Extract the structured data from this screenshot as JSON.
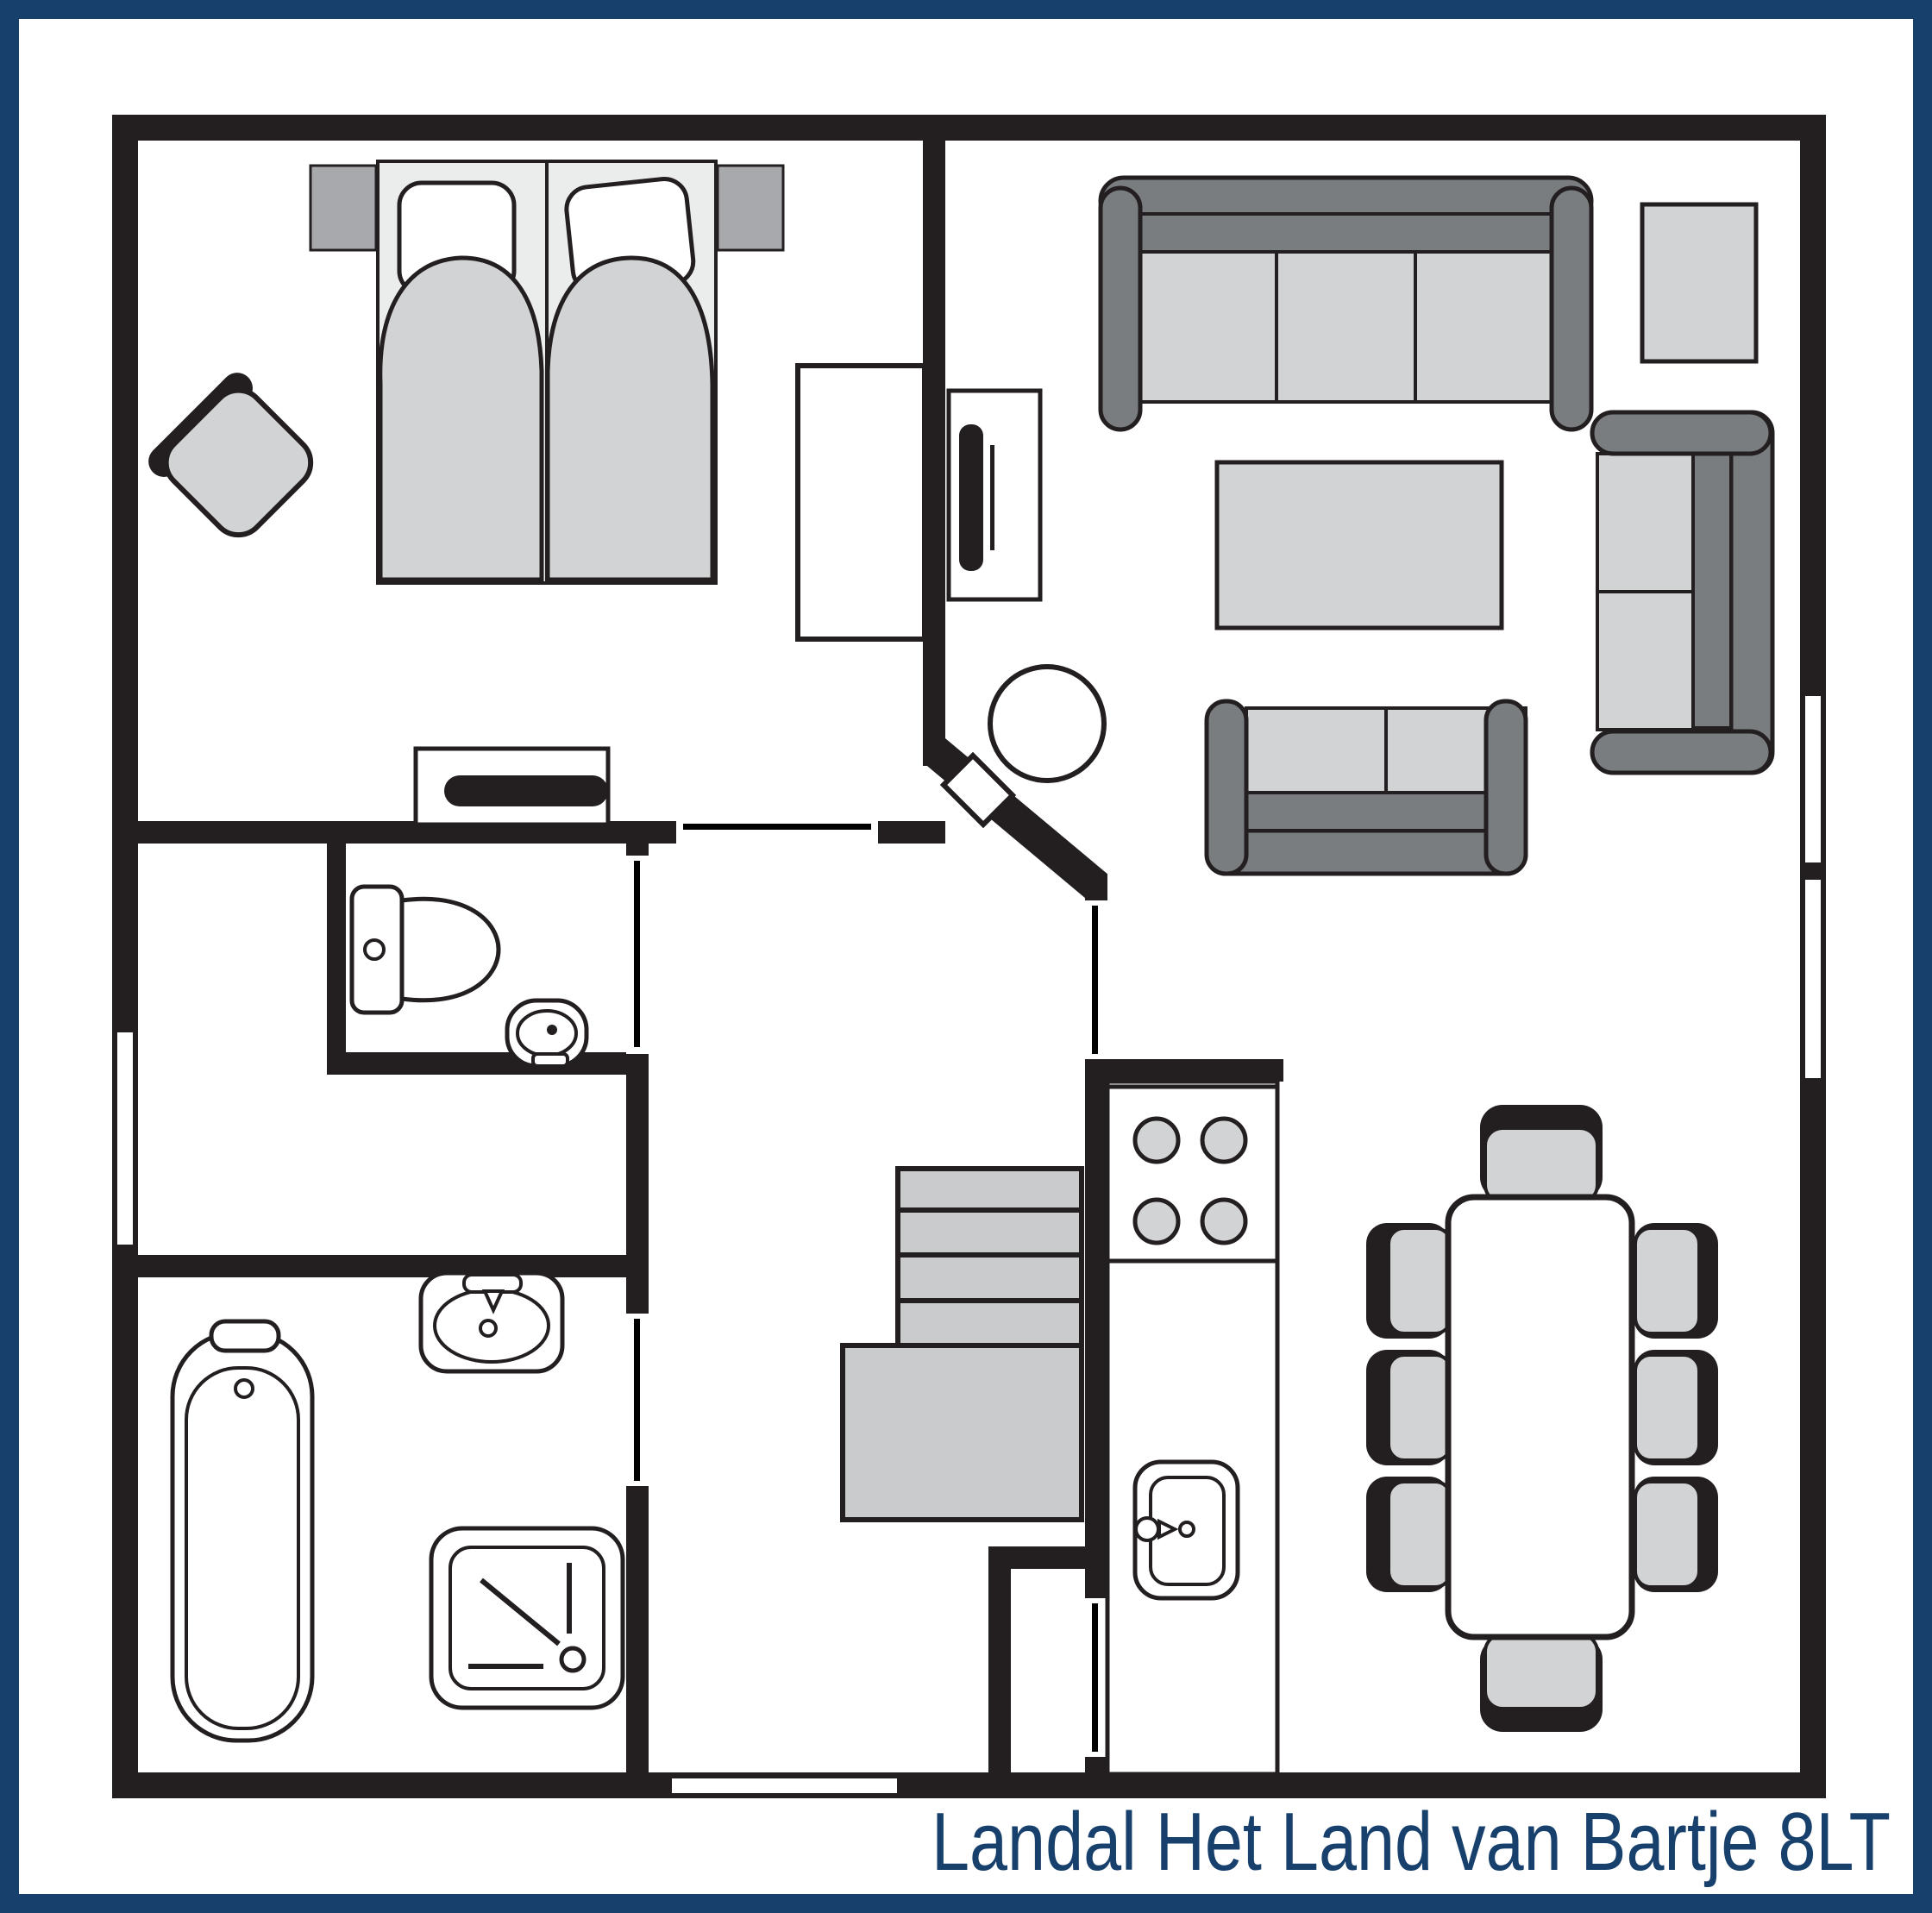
{
  "title": "Landal Het Land van Bartje 8LT",
  "colors": {
    "frame_navy": "#17406d",
    "wall": "#231f20",
    "furn_light": "#d2d3d5",
    "furn_mid": "#a7a9ac",
    "furn_dark": "#7a7d80",
    "stairs": "#c9cbcd",
    "bed": "#ebecec"
  },
  "floorplan": {
    "type": "holiday-cottage-ground-plan",
    "rooms": [
      "bedroom",
      "living-room",
      "hall",
      "toilet-room",
      "bathroom",
      "kitchen",
      "dining-area",
      "staircase",
      "entrance",
      "storage-closet"
    ],
    "furniture": [
      "double-bed",
      "pillow-left",
      "pillow-right",
      "nightstand-left",
      "nightstand-right",
      "bedroom-chair",
      "wardrobe",
      "dresser",
      "sofa-3-seat",
      "sofa-2-seat",
      "sofa-2-seat-vertical",
      "coffee-table",
      "side-table",
      "tv-cabinet",
      "wood-stove",
      "stairs",
      "kitchen-counter",
      "hob-4-burners",
      "kitchen-sink",
      "dining-table",
      "dining-chairs-x8",
      "toilet",
      "corner-washbasin",
      "washbasin",
      "bathtub",
      "shower"
    ],
    "openings": [
      "front-door",
      "bedroom-door",
      "toilet-door",
      "bathroom-door",
      "living-room-door",
      "closet-door",
      "window-left",
      "window-right-upper",
      "window-right-lower"
    ]
  }
}
